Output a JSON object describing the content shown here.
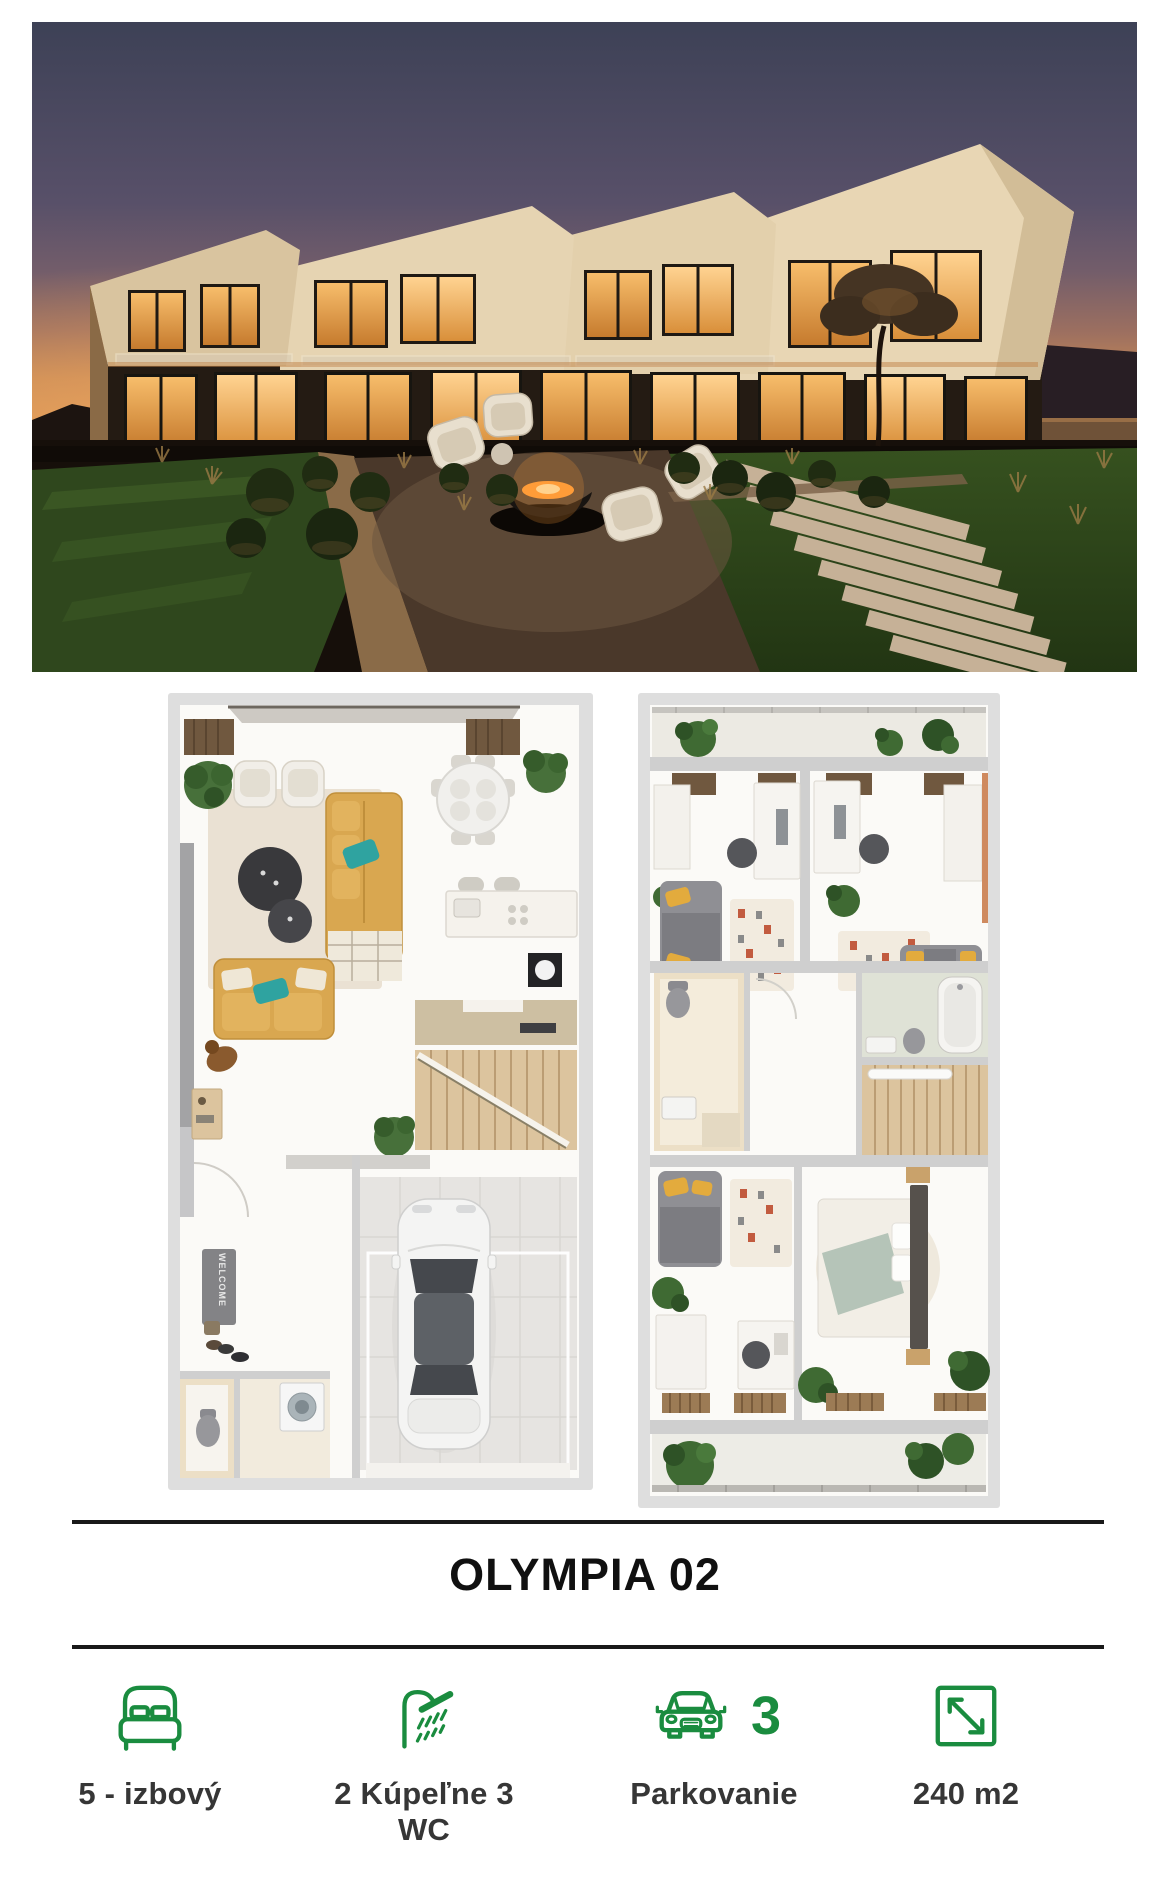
{
  "page": {
    "background": "#ffffff"
  },
  "hero": {
    "name": "exterior-photo"
  },
  "plans": {
    "ground": {
      "name": "ground-floor-plan",
      "mat_text": "WELCOME"
    },
    "upper": {
      "name": "upper-floor-plan"
    }
  },
  "title": {
    "text": "OLYMPIA 02"
  },
  "features": [
    {
      "icon": "bed-icon",
      "label": "5 - izbový"
    },
    {
      "icon": "shower-icon",
      "label": "2 Kúpeľne 3 WC"
    },
    {
      "icon": "car-icon",
      "count": "3",
      "label": "Parkovanie"
    },
    {
      "icon": "area-icon",
      "label": "240 m2"
    }
  ],
  "colors": {
    "accent_green": "#1a8c3f",
    "label_text": "#363636",
    "title_text": "#101010",
    "divider": "#191919"
  }
}
